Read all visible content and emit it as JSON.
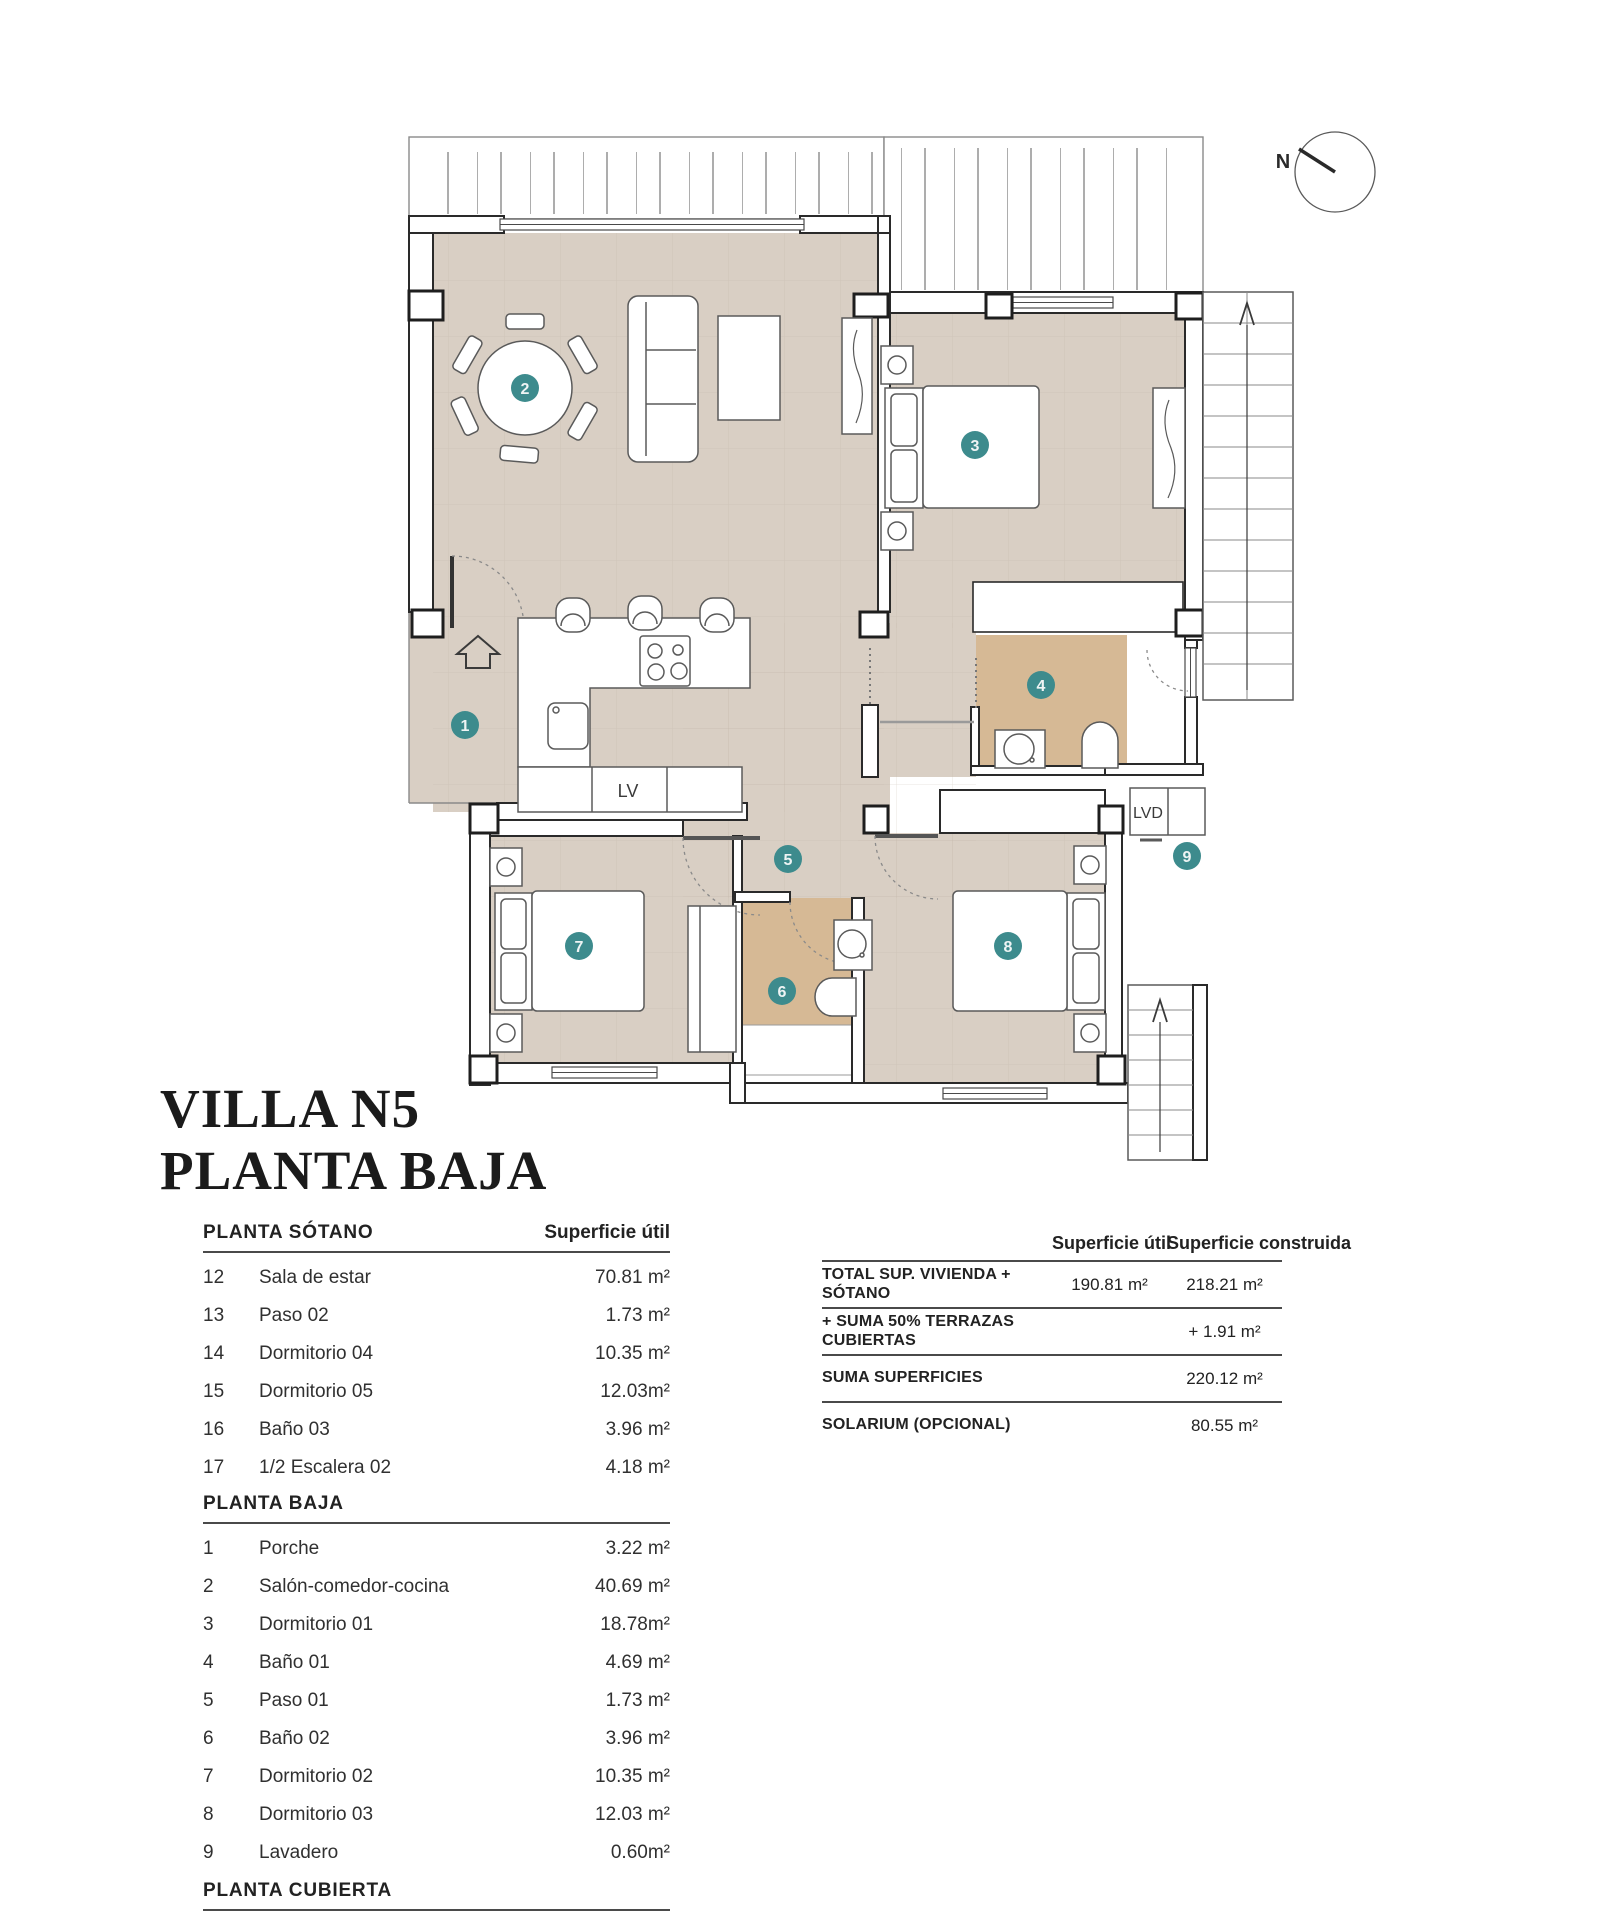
{
  "title": {
    "line1": "VILLA N5",
    "line2": "PLANTA BAJA"
  },
  "plan": {
    "north_label": "N",
    "dishwasher_label": "LV",
    "laundry_label": "LVD",
    "markers": [
      "1",
      "2",
      "3",
      "4",
      "5",
      "6",
      "7",
      "8",
      "9"
    ],
    "colors": {
      "floor": "#d9cfc4",
      "bath_floor": "#d6b995",
      "marker": "#3d8b8d",
      "wall": "#2a2a2a"
    }
  },
  "area_table": {
    "col_header": "Superficie útil",
    "sections": [
      {
        "header": "PLANTA SÓTANO",
        "rows": [
          {
            "num": "12",
            "name": "Sala de estar",
            "area": "70.81 m²"
          },
          {
            "num": "13",
            "name": "Paso 02",
            "area": "1.73 m²"
          },
          {
            "num": "14",
            "name": "Dormitorio 04",
            "area": "10.35 m²"
          },
          {
            "num": "15",
            "name": "Dormitorio 05",
            "area": "12.03m²"
          },
          {
            "num": "16",
            "name": "Baño 03",
            "area": "3.96 m²"
          },
          {
            "num": "17",
            "name": "1/2 Escalera 02",
            "area": "4.18 m²"
          }
        ]
      },
      {
        "header": "PLANTA BAJA",
        "rows": [
          {
            "num": "1",
            "name": "Porche",
            "area": "3.22 m²"
          },
          {
            "num": "2",
            "name": "Salón-comedor-cocina",
            "area": "40.69 m²"
          },
          {
            "num": "3",
            "name": "Dormitorio 01",
            "area": "18.78m²"
          },
          {
            "num": "4",
            "name": "Baño 01",
            "area": "4.69 m²"
          },
          {
            "num": "5",
            "name": "Paso 01",
            "area": "1.73 m²"
          },
          {
            "num": "6",
            "name": "Baño 02",
            "area": "3.96 m²"
          },
          {
            "num": "7",
            "name": "Dormitorio 02",
            "area": "10.35 m²"
          },
          {
            "num": "8",
            "name": "Dormitorio 03",
            "area": "12.03 m²"
          },
          {
            "num": "9",
            "name": "Lavadero",
            "area": "0.60m²"
          }
        ]
      },
      {
        "header": "PLANTA CUBIERTA",
        "rows": []
      }
    ]
  },
  "summary_table": {
    "col1_header": "Superficie útil",
    "col2_header": "Superficie construida",
    "rows": [
      {
        "label": "TOTAL SUP. VIVIENDA + SÓTANO",
        "util": "190.81  m²",
        "construida": "218.21 m²"
      },
      {
        "label": "+ SUMA 50% TERRAZAS CUBIERTAS",
        "util": "",
        "construida": "+ 1.91 m²"
      },
      {
        "label": "SUMA SUPERFICIES",
        "util": "",
        "construida": "220.12 m²"
      },
      {
        "label": "SOLARIUM (OPCIONAL)",
        "util": "",
        "construida": "80.55 m²"
      }
    ]
  }
}
